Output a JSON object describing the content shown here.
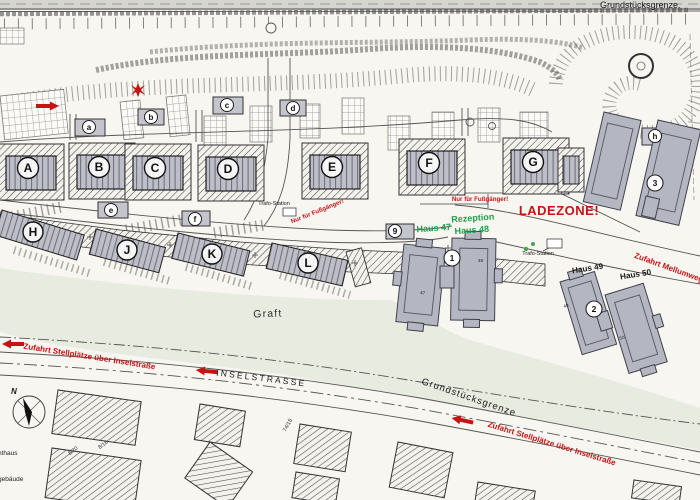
{
  "plan": {
    "boundary_top": "Grundstücksgrenze.",
    "boundary_bottom": "Grundstücksgrenze",
    "streets": {
      "inselstrasse": "INSELSTRASSE",
      "graft": "Graft"
    },
    "red": {
      "ladezone": "LADEZONE!",
      "ped_diagonal": "Nur für Fußgänger!",
      "ped_horizontal": "Nur für Fußgänger!",
      "access_left": "Zufahrt Stellplätze über Inselstraße",
      "access_right": "Zufahrt Stellplätze über Inselstraße",
      "mellumweg": "Zufahrt Mellumweg"
    },
    "green": {
      "haus47": "Haus 47",
      "rezeption": "Rezeption",
      "haus48": "Haus 48"
    },
    "houses": {
      "haus49": "Haus 49",
      "haus50": "Haus 50"
    },
    "trafo": {
      "t1": "Trafo-Station",
      "t2": "Trafo-Station"
    },
    "blocks": [
      "A",
      "B",
      "C",
      "D",
      "E",
      "F",
      "G"
    ],
    "rows": [
      "H",
      "J",
      "K",
      "L"
    ],
    "outbuildings": [
      "a",
      "b",
      "c",
      "d",
      "e",
      "f",
      "h"
    ],
    "circles": [
      "1",
      "2",
      "3",
      "9"
    ],
    "units": [
      "47",
      "48",
      "49",
      "50"
    ],
    "plots": [
      "8/20",
      "8/18",
      "74/18"
    ],
    "compass_n": "N",
    "edge_labels": [
      "nthaus",
      "gebäude"
    ]
  },
  "colors": {
    "annotation_red": "#c41414",
    "annotation_green": "#1f9e4b",
    "building_gray": "#b4b6c1",
    "graft_band": "#e8ebdf",
    "paper": "#f7f6f1"
  }
}
